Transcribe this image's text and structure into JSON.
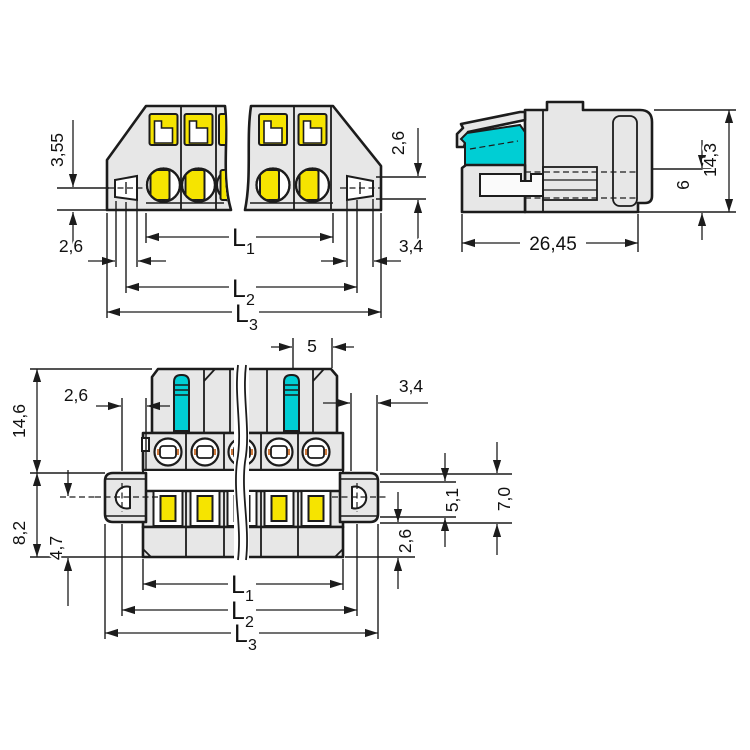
{
  "drawing": {
    "background": "#ffffff",
    "line_color": "#1c1c1c",
    "body_fill": "#e7e7e7",
    "accent_yellow": "#f6e400",
    "accent_cyan": "#00ced4",
    "accent_orange": "#cf7a3d",
    "views": {
      "front": {
        "title": "front-view-with-mounting-flanges",
        "dims": {
          "d355": "3,55",
          "left26": "2,6",
          "right26": "2,6",
          "right34": "3,4",
          "L1b": "L",
          "L1s": "1",
          "L2b": "L",
          "L2s": "2",
          "L3b": "L",
          "L3s": "3"
        }
      },
      "side": {
        "title": "side-view",
        "dims": {
          "w2645": "26,45",
          "h6": "6",
          "h143": "14,3"
        }
      },
      "bottom": {
        "title": "bottom-view-with-levers",
        "dims": {
          "pitch5": "5",
          "left26": "2,6",
          "right34": "3,4",
          "h146": "14,6",
          "h82": "8,2",
          "h47": "4,7",
          "h51": "5,1",
          "h70": "7,0",
          "r26": "2,6",
          "L1b": "L",
          "L1s": "1",
          "L2b": "L",
          "L2s": "2",
          "L3b": "L",
          "L3s": "3"
        }
      }
    }
  }
}
